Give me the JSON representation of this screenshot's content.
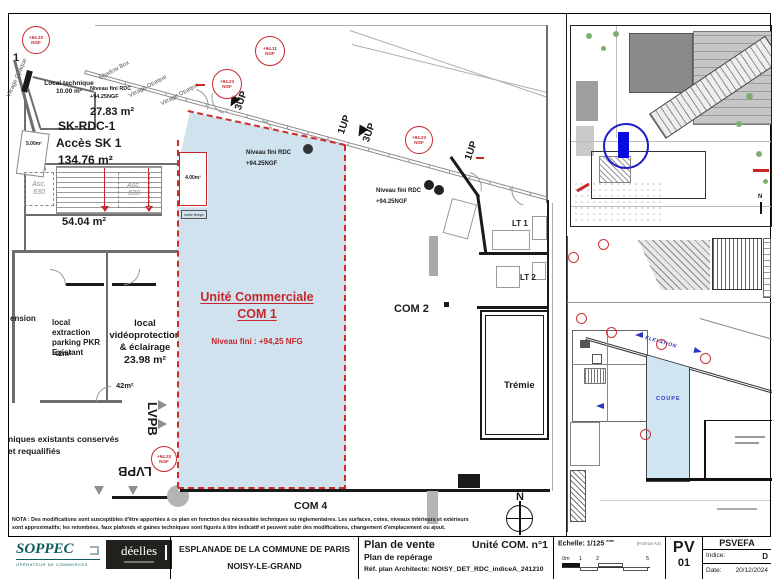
{
  "colors": {
    "unit_fill": "#cfe2ee",
    "dashed_red": "#d02b2b",
    "annot_red": "#c5272d",
    "inset_blue": "#0a0ae0",
    "teal": "#0d5c5c"
  },
  "main_plan": {
    "grid_mark": "1",
    "facade_labels": [
      "Vitrage Opaque",
      "Shadow Box",
      "Vitrage Opaque",
      "Vitrage Opaque"
    ],
    "up_labels": [
      "3UP",
      "1UP",
      "3UP",
      "1UP"
    ],
    "badges": [
      {
        "v": "+94.23",
        "u": "NGF"
      },
      {
        "v": "+94.11",
        "u": "NGF"
      },
      {
        "v": "+94.23",
        "u": "NGF"
      },
      {
        "v": "+94.23",
        "u": "NGF"
      },
      {
        "v": "+94.23",
        "u": "NGF"
      }
    ],
    "left_wing": {
      "local_technique_l1": "Local technique",
      "local_technique_l2": "10.00 m²",
      "niveau_l1": "Niveau fini RDC",
      "niveau_l2": "+94.25NGF",
      "corridor_area": "27.83 m²",
      "sk_name": "SK-RDC-1",
      "sk_access": "Accès SK 1",
      "sk_area": "134.76 m²",
      "small_area": "5.00m²",
      "lift_label": "Asc.",
      "lift_number": "630",
      "hall_area": "54.04 m²",
      "extension": "ension",
      "extraction_l1": "local extraction",
      "extraction_l2": "parking PKR",
      "extraction_l3": "Existant",
      "extraction_area": "42m²",
      "video_l1": "local",
      "video_l2": "vidéoprotection",
      "video_l3": "& éclairage",
      "video_area": "23.98 m²",
      "video_area2": "42m²",
      "lvpb": "LVPB",
      "conserves_l1": "niques existants conservés",
      "conserves_l2": "et requalifiés"
    },
    "com1": {
      "niveau_l1": "Niveau fini RDC",
      "niveau_l2": "+94.25NGF",
      "title": "Unité Commerciale",
      "name": "COM 1",
      "niveau_fini": "Niveau fini : +94,25 NFG",
      "room4_area": "4.00m²",
      "room4_note": "sortie tempo"
    },
    "com2": {
      "name": "COM 2",
      "niveau_l1": "Niveau fini RDC",
      "niveau_l2": "+94.25NGF"
    },
    "com4": {
      "name": "COM 4"
    },
    "lt1": "LT 1",
    "lt2": "LT 2",
    "tremie": "Trémie",
    "north": "N",
    "nota_l1": "NOTA : Des modifications sont susceptibles d'être apportées à ce plan en fonction des nécessités techniques ou réglementaires. Les surfaces, cotes, niveaux intérieurs et extérieurs",
    "nota_l2": "sont approximatifs; les retombées, faux plafonds et gaines techniques sont figurés à titre indicatif et peuvent subir des modifications, changement d'emplacement ou ajout."
  },
  "insets": {
    "site": {
      "north": "N"
    },
    "detail": {
      "elevation": "ELEVATION",
      "coupe": "COUPE"
    }
  },
  "title_block": {
    "soppec": {
      "name": "SOPPEC",
      "tagline": "OPÉRATEUR DE COMMERCES"
    },
    "deelles": {
      "name": "déelles"
    },
    "project_l1": "ESPLANADE DE LA COMMUNE DE PARIS",
    "project_l2": "NOISY-LE-GRAND",
    "doc_type": "Plan de vente",
    "doc_unit": "Unité COM. n°1",
    "doc_type2": "Plan de repérage",
    "doc_ref": "Réf. plan Architecte:  NOISY_DET_RDC_indiceA_241210",
    "scale_label": "Echelle: 1/125",
    "scale_sup": "ème",
    "scale_format": "(Format A3)",
    "scale_marks": [
      "0m",
      "1",
      "2",
      "5"
    ],
    "pv": "PV",
    "pv_num": "01",
    "program": "PSVEFA",
    "indice_label": "Indice:",
    "indice": "D",
    "date_label": "Date:",
    "date": "20/12/2024"
  }
}
